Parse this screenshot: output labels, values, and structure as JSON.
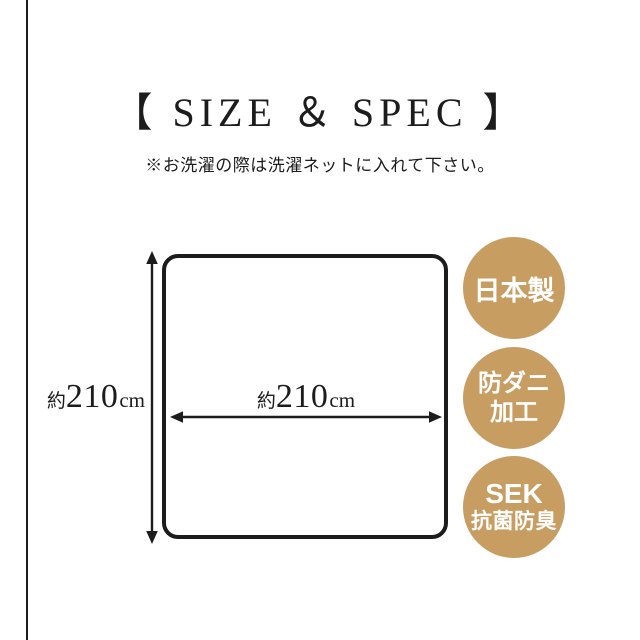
{
  "colors": {
    "background": "#ffffff",
    "ink": "#1c1c1c",
    "badge_gold": "#c89d62",
    "badge_text": "#ffffff"
  },
  "header": {
    "title": "【 SIZE ＆ SPEC 】",
    "note": "※お洗濯の際は洗濯ネットに入れて下さい。"
  },
  "diagram": {
    "shape": "rounded-square product outline with double-headed dimension arrows",
    "height_label": {
      "prefix": "約",
      "value": "210",
      "unit": "cm"
    },
    "width_label": {
      "prefix": "約",
      "value": "210",
      "unit": "cm"
    }
  },
  "badges": [
    {
      "name": "made-in-japan",
      "lines": [
        "日本製"
      ]
    },
    {
      "name": "anti-mite-treatment",
      "lines": [
        "防ダニ",
        "加工"
      ]
    },
    {
      "name": "sek-antibacterial-deodorizing",
      "lines": [
        "SEK",
        "抗菌防臭"
      ]
    }
  ]
}
